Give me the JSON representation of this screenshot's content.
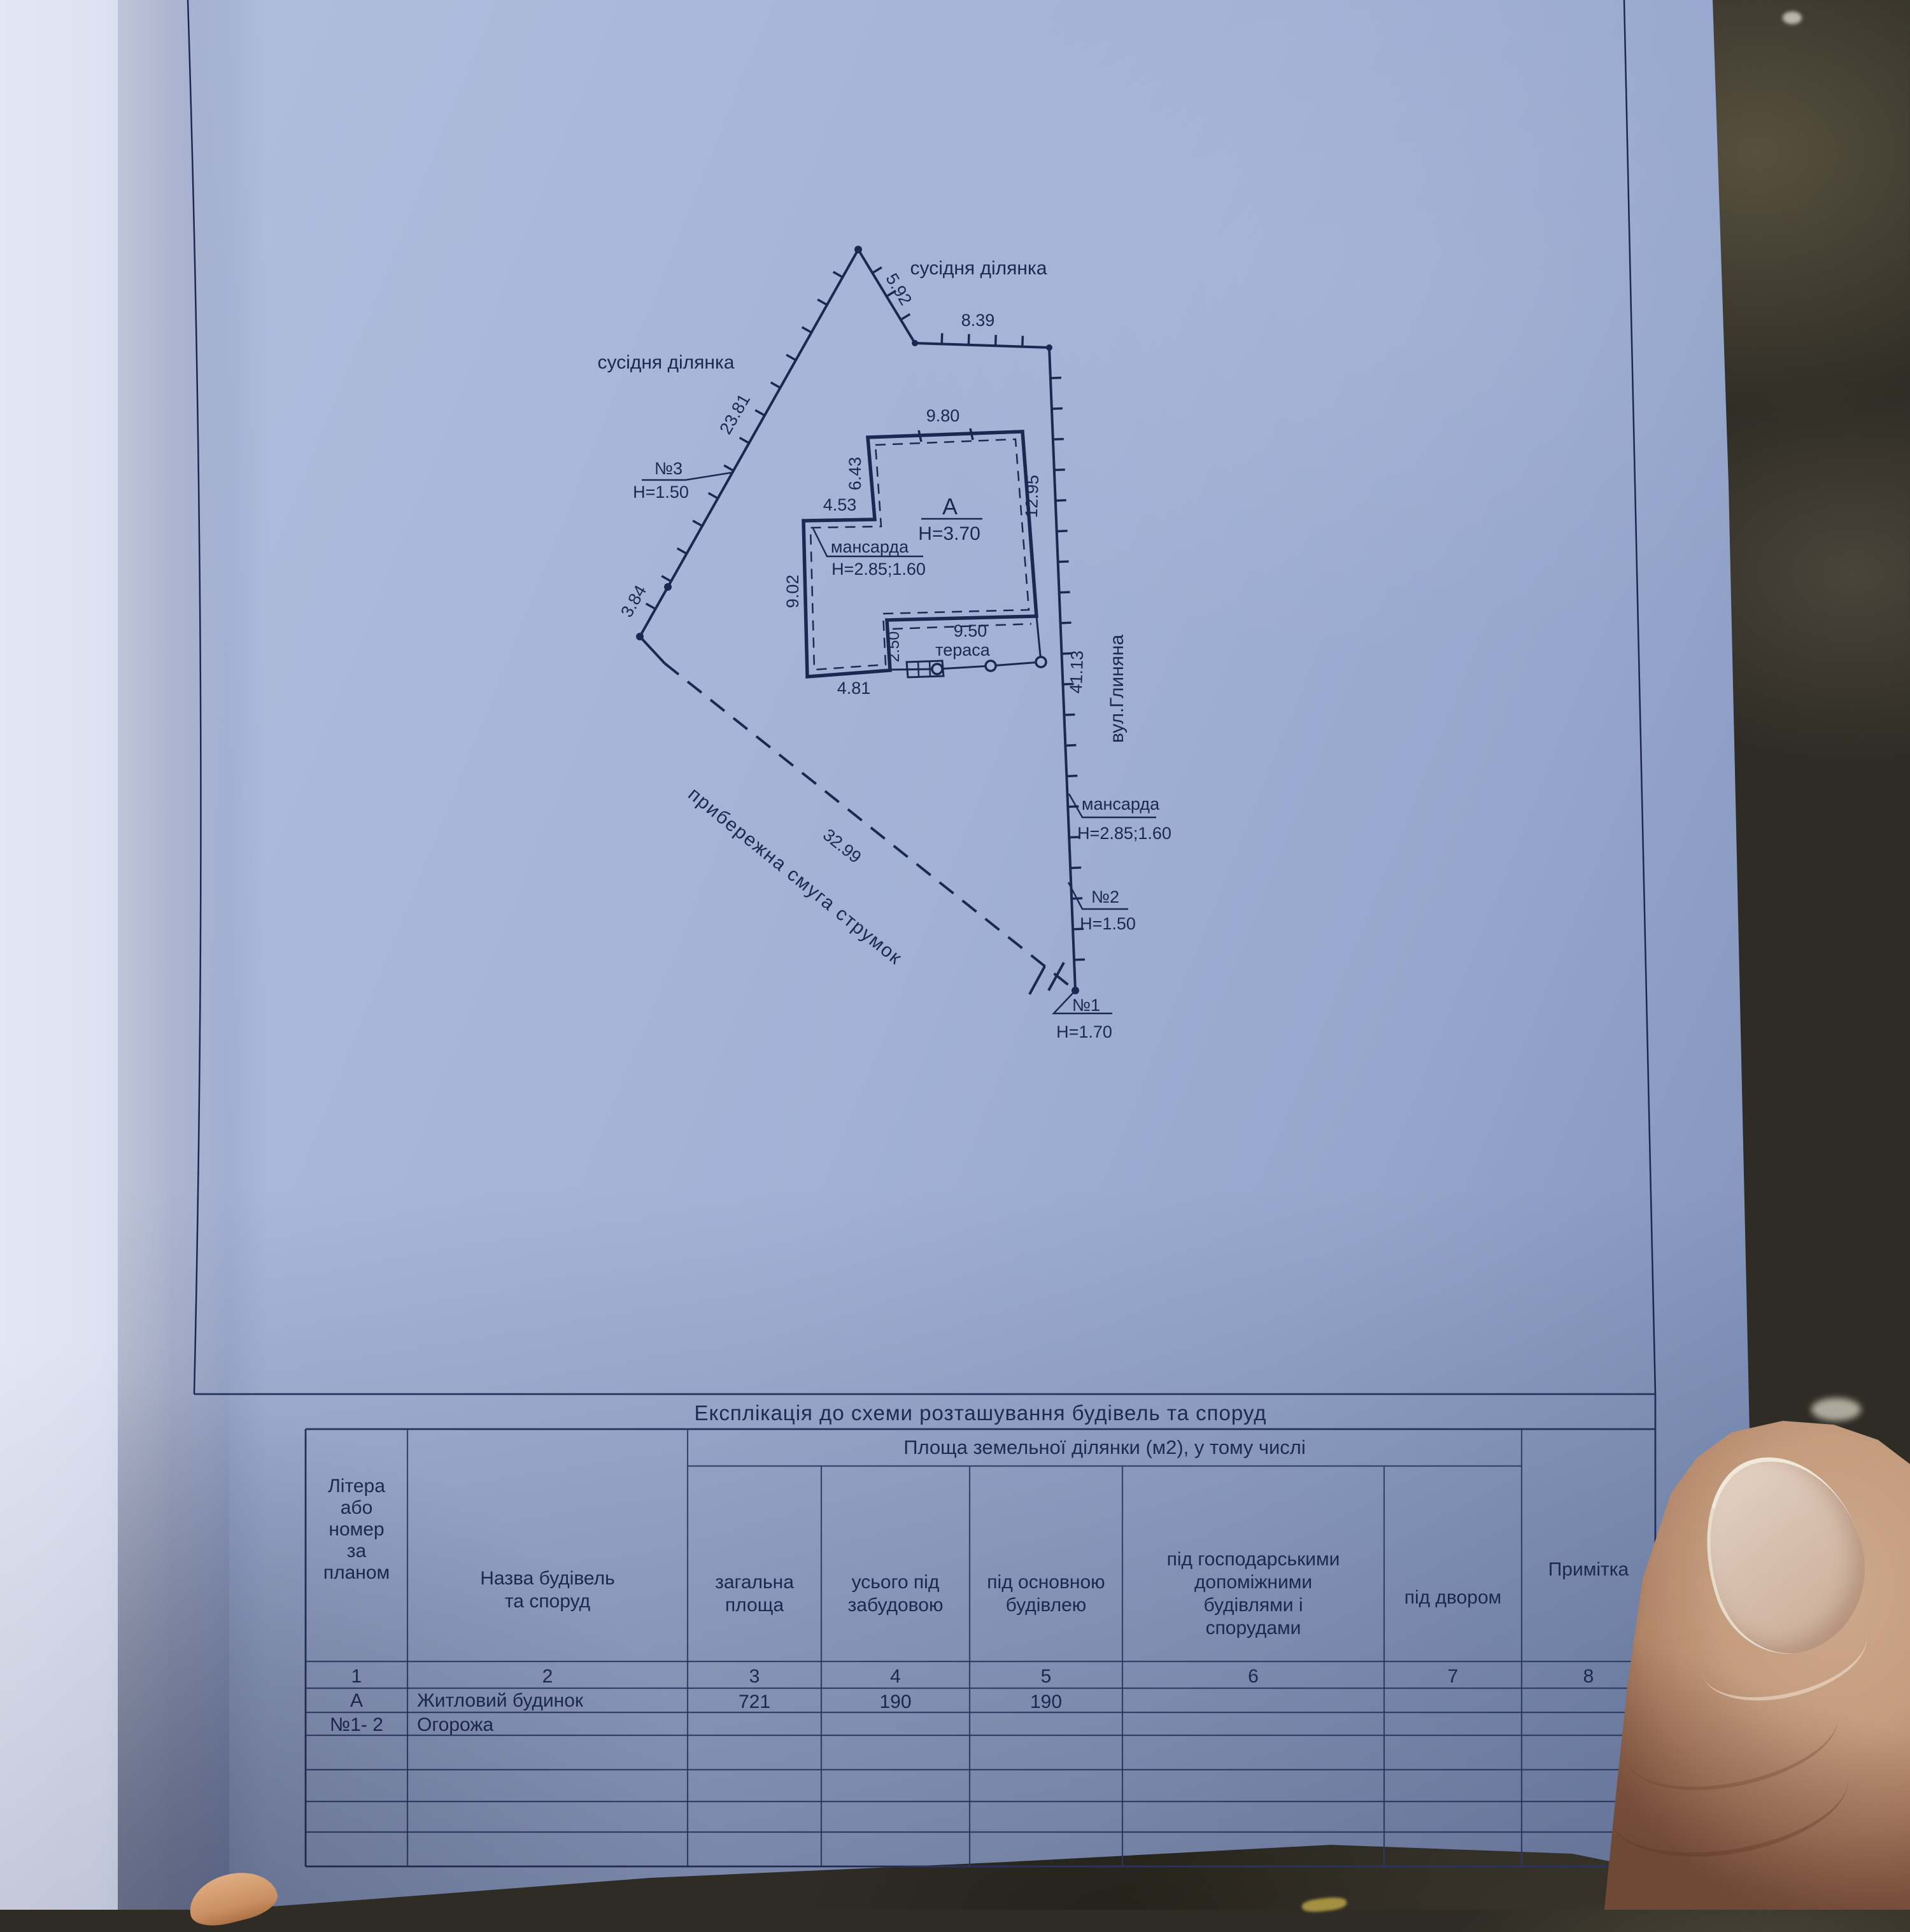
{
  "plan": {
    "labels": {
      "neighbor_top": "сусідня ділянка",
      "neighbor_left": "сусідня ділянка",
      "street": "вул.Глиняна",
      "coastal_strip": "прибережна смуга струмок",
      "terrace": "тераса",
      "building_letter": "А",
      "building_height": "Н=3.70",
      "mansarda_left": "мансарда",
      "mansarda_left_height": "Н=2.85;1.60",
      "mansarda_right": "мансарда",
      "mansarda_right_height": "Н=2.85;1.60",
      "point3": "№3",
      "point3_height": "Н=1.50",
      "point2": "№2",
      "point2_height": "Н=1.50",
      "point1": "№1",
      "point1_height": "Н=1.70"
    },
    "dims": {
      "seg_5_92": "5.92",
      "seg_8_39": "8.39",
      "bldg_9_80": "9.80",
      "bldg_6_43": "6.43",
      "bldg_4_53": "4.53",
      "bldg_9_02": "9.02",
      "bldg_4_81": "4.81",
      "terr_2_50": "2.50",
      "terr_9_50": "9.50",
      "seg_12_95": "12.95",
      "seg_41_13": "41.13",
      "seg_23_81": "23.81",
      "seg_3_84": "3.84",
      "seg_32_99": "32.99"
    }
  },
  "table": {
    "title": "Експлікація до схеми розташування будівель та споруд",
    "area_header": "Площа  земельної ділянки (м2), у тому числі",
    "columns": [
      {
        "num": "1",
        "label": "Літера\nабо\nномер\nза\nпланом"
      },
      {
        "num": "2",
        "label": "Назва будівель\nта споруд"
      },
      {
        "num": "3",
        "label": "загальна\nплоща"
      },
      {
        "num": "4",
        "label": "усього під\nзабудовою"
      },
      {
        "num": "5",
        "label": "під основною\nбудівлею"
      },
      {
        "num": "6",
        "label": "під господарськими\nдопоміжними\nбудівлями і\nспорудами"
      },
      {
        "num": "7",
        "label": "під двором"
      },
      {
        "num": "8",
        "label": "Примітка"
      }
    ],
    "rows": [
      {
        "cells": [
          "А",
          "Житловий будинок",
          "721",
          "190",
          "190",
          "",
          "",
          ""
        ]
      },
      {
        "cells": [
          "№1- 2",
          "Огорожа",
          "",
          "",
          "",
          "",
          "",
          ""
        ]
      }
    ],
    "empty_row_count": 4
  }
}
